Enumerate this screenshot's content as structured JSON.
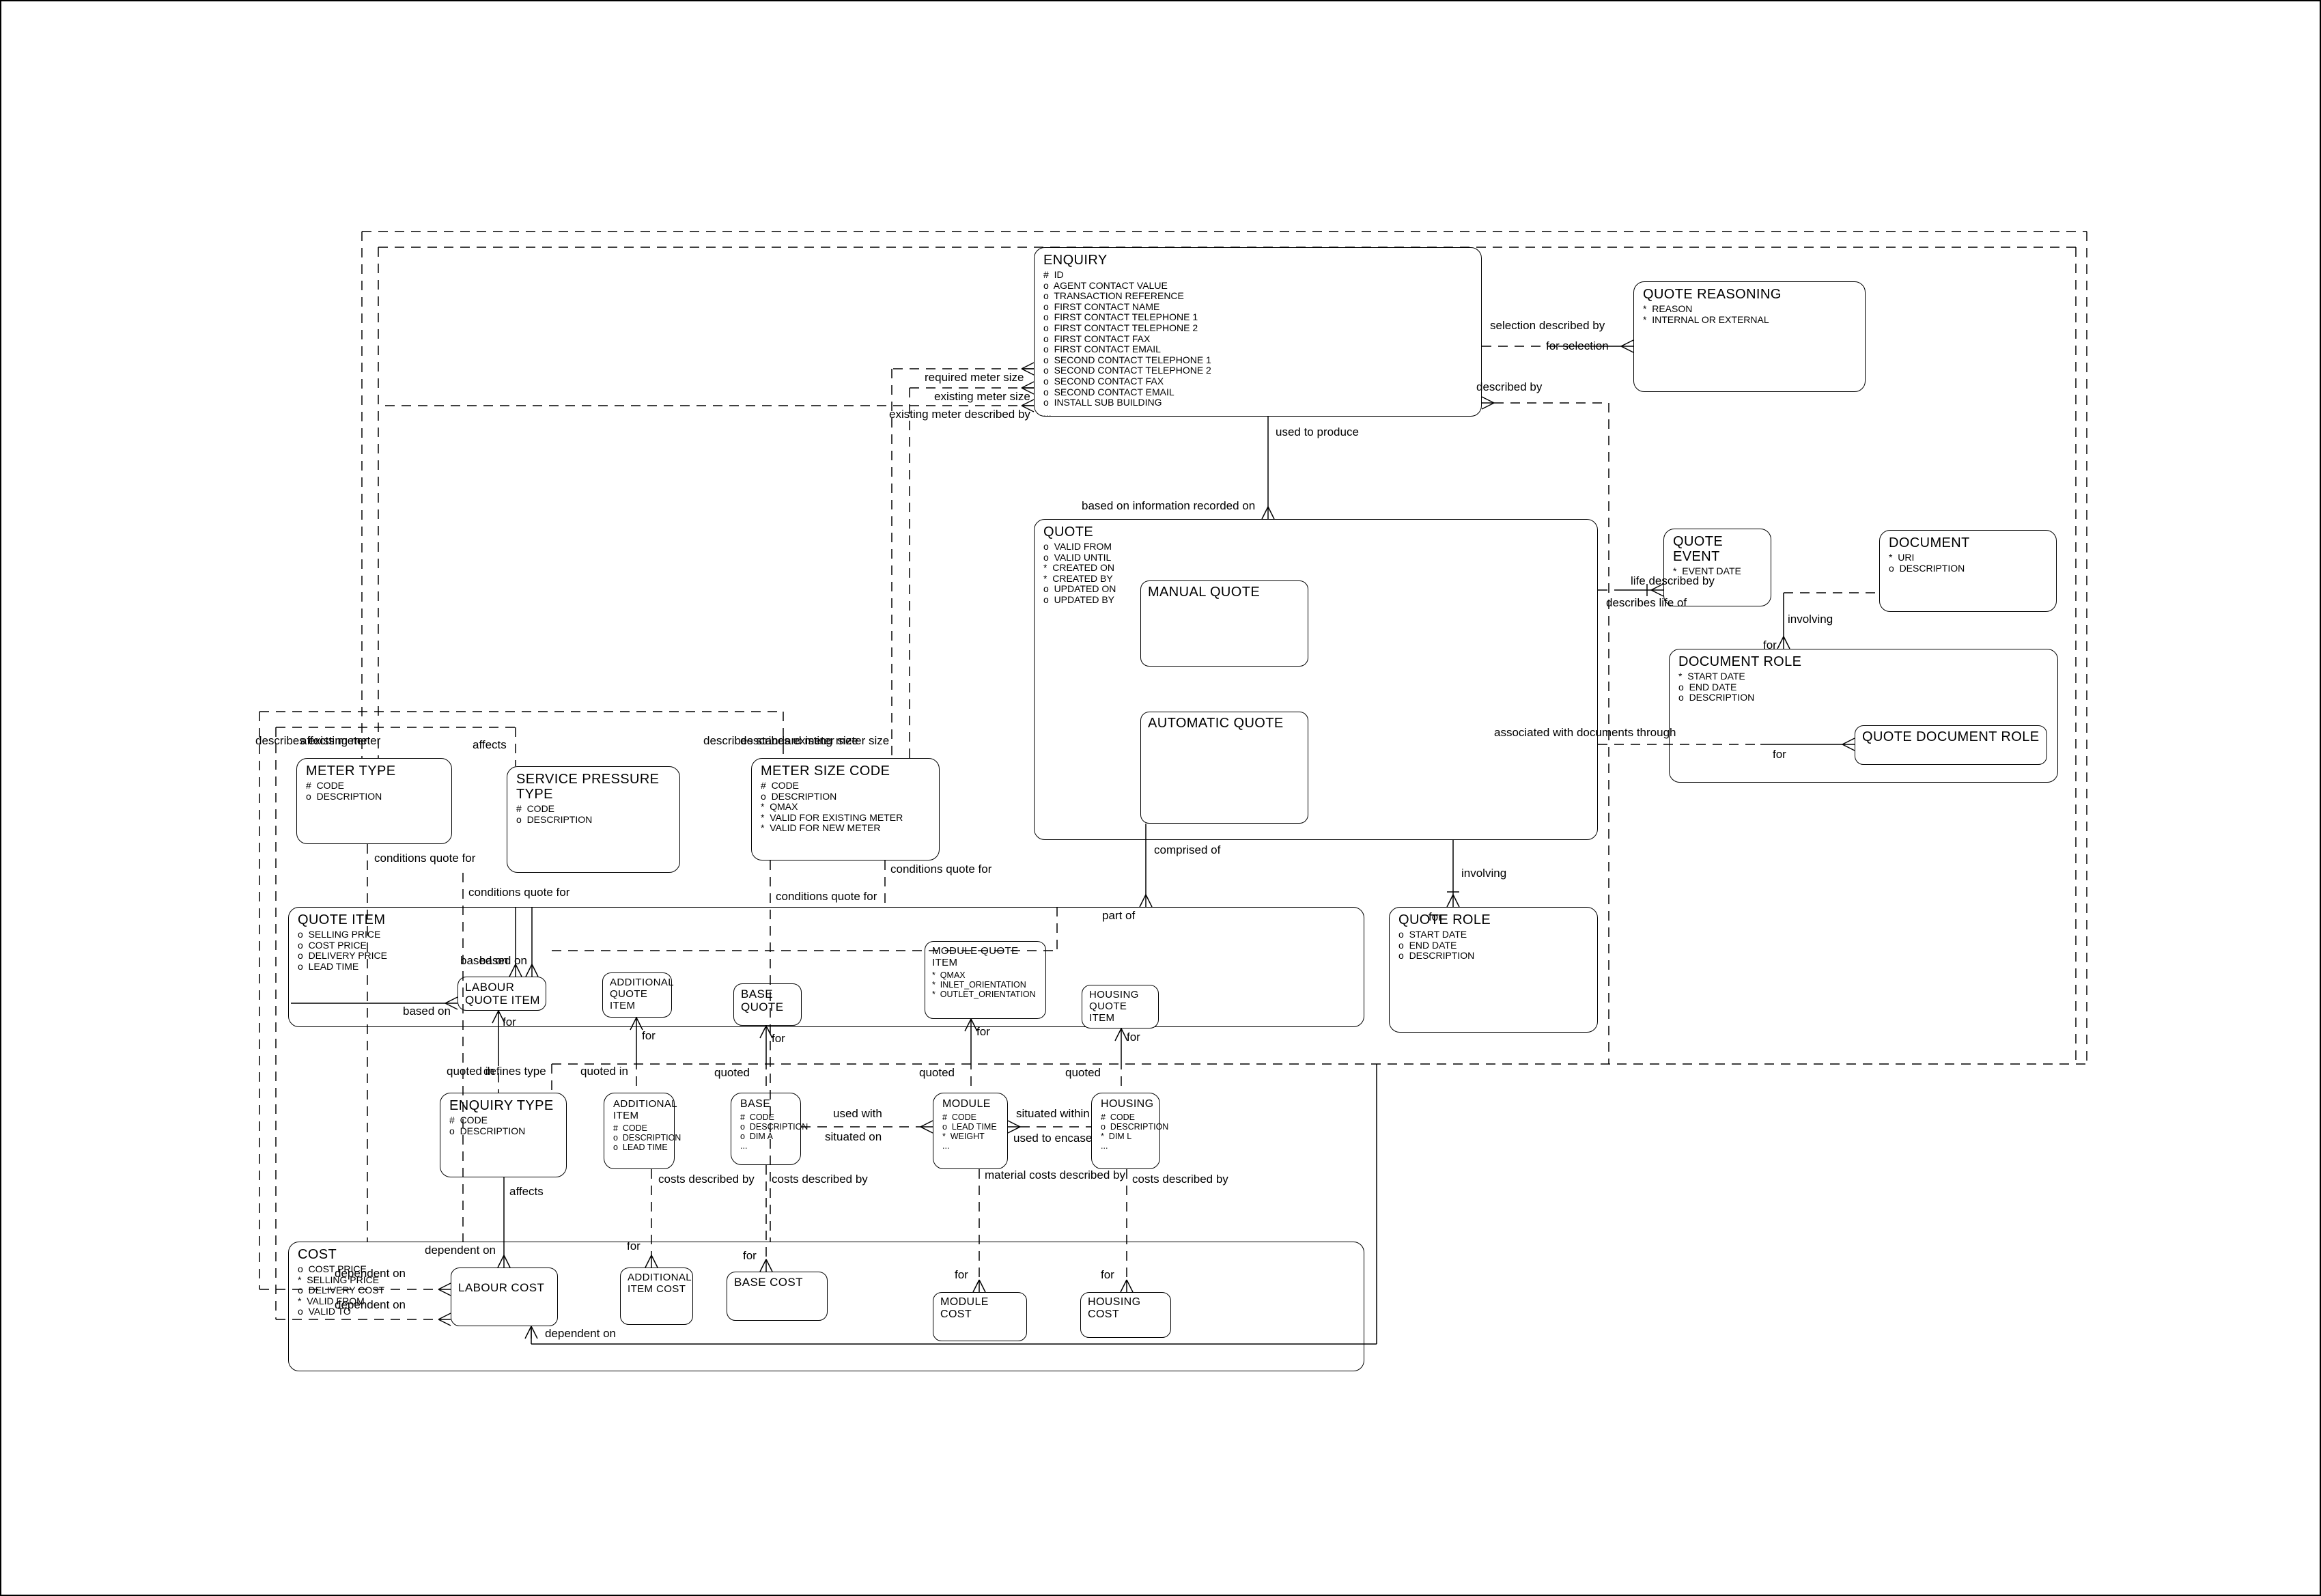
{
  "entities": {
    "enquiry": {
      "title": "ENQUIRY",
      "attrs": [
        "#  ID",
        "o  AGENT CONTACT VALUE",
        "o  TRANSACTION REFERENCE",
        "o  FIRST CONTACT NAME",
        "o  FIRST CONTACT TELEPHONE 1",
        "o  FIRST CONTACT TELEPHONE 2",
        "o  FIRST CONTACT FAX",
        "o  FIRST CONTACT EMAIL",
        "o  SECOND CONTACT TELEPHONE 1",
        "o  SECOND CONTACT TELEPHONE 2",
        "o  SECOND CONTACT FAX",
        "o  SECOND CONTACT EMAIL",
        "o  INSTALL SUB BUILDING",
        "..."
      ]
    },
    "quote_reasoning": {
      "title": "QUOTE REASONING",
      "attrs": [
        "*  REASON",
        "*  INTERNAL OR EXTERNAL"
      ]
    },
    "quote": {
      "title": "QUOTE",
      "attrs": [
        "o  VALID FROM",
        "o  VALID UNTIL",
        "*  CREATED ON",
        "*  CREATED BY",
        "o  UPDATED ON",
        "o  UPDATED BY"
      ]
    },
    "manual_quote": {
      "title": "MANUAL QUOTE",
      "attrs": []
    },
    "automatic_quote": {
      "title": "AUTOMATIC QUOTE",
      "attrs": []
    },
    "quote_event": {
      "title": "QUOTE EVENT",
      "attrs": [
        "*  EVENT DATE"
      ]
    },
    "document": {
      "title": "DOCUMENT",
      "attrs": [
        "*  URI",
        "o  DESCRIPTION"
      ]
    },
    "document_role": {
      "title": "DOCUMENT ROLE",
      "attrs": [
        "*  START DATE",
        "o  END DATE",
        "o  DESCRIPTION"
      ]
    },
    "quote_document_role": {
      "title": "QUOTE DOCUMENT ROLE",
      "attrs": []
    },
    "meter_type": {
      "title": "METER TYPE",
      "attrs": [
        "#  CODE",
        "o  DESCRIPTION"
      ]
    },
    "service_pressure_type": {
      "title": "SERVICE PRESSURE TYPE",
      "attrs": [
        "#  CODE",
        "o  DESCRIPTION"
      ]
    },
    "meter_size_code": {
      "title": "METER SIZE CODE",
      "attrs": [
        "#  CODE",
        "o  DESCRIPTION",
        "*  QMAX",
        "*  VALID FOR EXISTING METER",
        "*  VALID FOR NEW METER"
      ]
    },
    "quote_item": {
      "title": "QUOTE ITEM",
      "attrs": [
        "o  SELLING PRICE",
        "o  COST PRICE",
        "o  DELIVERY PRICE",
        "o  LEAD TIME"
      ]
    },
    "labour_quote_item": {
      "title": "LABOUR QUOTE ITEM",
      "attrs": []
    },
    "additional_quote_item": {
      "title": "ADDITIONAL QUOTE ITEM",
      "attrs": []
    },
    "base_quote": {
      "title": "BASE QUOTE",
      "attrs": []
    },
    "module_quote_item": {
      "title": "MODULE QUOTE ITEM",
      "attrs": [
        "*  QMAX",
        "*  INLET_ORIENTATION",
        "*  OUTLET_ORIENTATION"
      ]
    },
    "housing_quote_item": {
      "title": "HOUSING QUOTE ITEM",
      "attrs": []
    },
    "quote_role": {
      "title": "QUOTE ROLE",
      "attrs": [
        "o  START DATE",
        "o  END DATE",
        "o  DESCRIPTION"
      ]
    },
    "enquiry_type": {
      "title": "ENQUIRY TYPE",
      "attrs": [
        "#  CODE",
        "o  DESCRIPTION"
      ]
    },
    "additional_item": {
      "title": "ADDITIONAL ITEM",
      "attrs": [
        "#  CODE",
        "o  DESCRIPTION",
        "o  LEAD TIME"
      ]
    },
    "base": {
      "title": "BASE",
      "attrs": [
        "#  CODE",
        "o  DESCRIPTION",
        "o  DIM A",
        "..."
      ]
    },
    "module": {
      "title": "MODULE",
      "attrs": [
        "#  CODE",
        "o  LEAD TIME",
        "*  WEIGHT",
        "..."
      ]
    },
    "housing": {
      "title": "HOUSING",
      "attrs": [
        "#  CODE",
        "o  DESCRIPTION",
        "*  DIM L",
        "..."
      ]
    },
    "cost": {
      "title": "COST",
      "attrs": [
        "o  COST PRICE",
        "*  SELLING PRICE",
        "o  DELIVERY COST",
        "*  VALID FROM",
        "o  VALID TO"
      ]
    },
    "labour_cost": {
      "title": "LABOUR COST",
      "attrs": []
    },
    "additional_item_cost": {
      "title": "ADDITIONAL ITEM COST",
      "attrs": []
    },
    "base_cost": {
      "title": "BASE COST",
      "attrs": []
    },
    "module_cost": {
      "title": "MODULE COST",
      "attrs": []
    },
    "housing_cost": {
      "title": "HOUSING COST",
      "attrs": []
    }
  },
  "labels": {
    "selection_described_by": "selection described by",
    "for_selection": "for selection",
    "described_by": "described by",
    "used_to_produce": "used to produce",
    "based_on_information": "based on information recorded on",
    "life_described_by": "life described by",
    "describes_life_of": "describes life of",
    "involving_document": "involving",
    "for_document_role": "for",
    "associated_with_documents": "associated with documents through",
    "for_quote_document_role": "for",
    "comprised_of": "comprised of",
    "part_of": "part of",
    "involving_role": "involving",
    "for_role": "for",
    "required_meter_size": "required meter size",
    "existing_meter_size": "existing meter size",
    "existing_meter_described_by": "existing meter described by",
    "describes_existing_meter": "describes existing meter",
    "affects_meter": "affects meter",
    "affects_service_pressure": "affects",
    "describes_standard_meter_size": "describes standard meter size",
    "describes_existing_meter_size": "describes existing meter size",
    "conditions_quote_for_1": "conditions quote for",
    "conditions_quote_for_2": "conditions quote for",
    "conditions_quote_for_3": "conditions quote for",
    "conditions_quote_for_4": "conditions quote for",
    "based_on_a": "based on",
    "based_on_b": "based on",
    "based_on_left": "based on",
    "for_labour_quote_item": "for",
    "quoted_in_enquiry_type": "quoted in",
    "defines_type": "defines type",
    "quoted_in_additional": "quoted in",
    "quoted_base": "quoted",
    "quoted_module": "quoted",
    "quoted_housing": "quoted",
    "for_additional_quote_item": "for",
    "for_base_quote": "for",
    "for_module_quote_item": "for",
    "for_housing_quote_item": "for",
    "used_with": "used with",
    "situated_on": "situated on",
    "situated_within": "situated within",
    "used_to_encase": "used to encase",
    "affects_enquiry_type": "affects",
    "costs_described_by_additional": "costs described by",
    "costs_described_by_base": "costs described by",
    "material_costs_described_by": "material costs described by",
    "costs_described_by_housing": "costs described by",
    "dependent_on_top": "dependent on",
    "for_additional_item_cost": "for",
    "for_base_cost": "for",
    "for_module_cost": "for",
    "for_housing_cost": "for",
    "dependent_on_left_1": "dependent on",
    "dependent_on_left_2": "dependent on",
    "dependent_on_bottom": "dependent on"
  }
}
